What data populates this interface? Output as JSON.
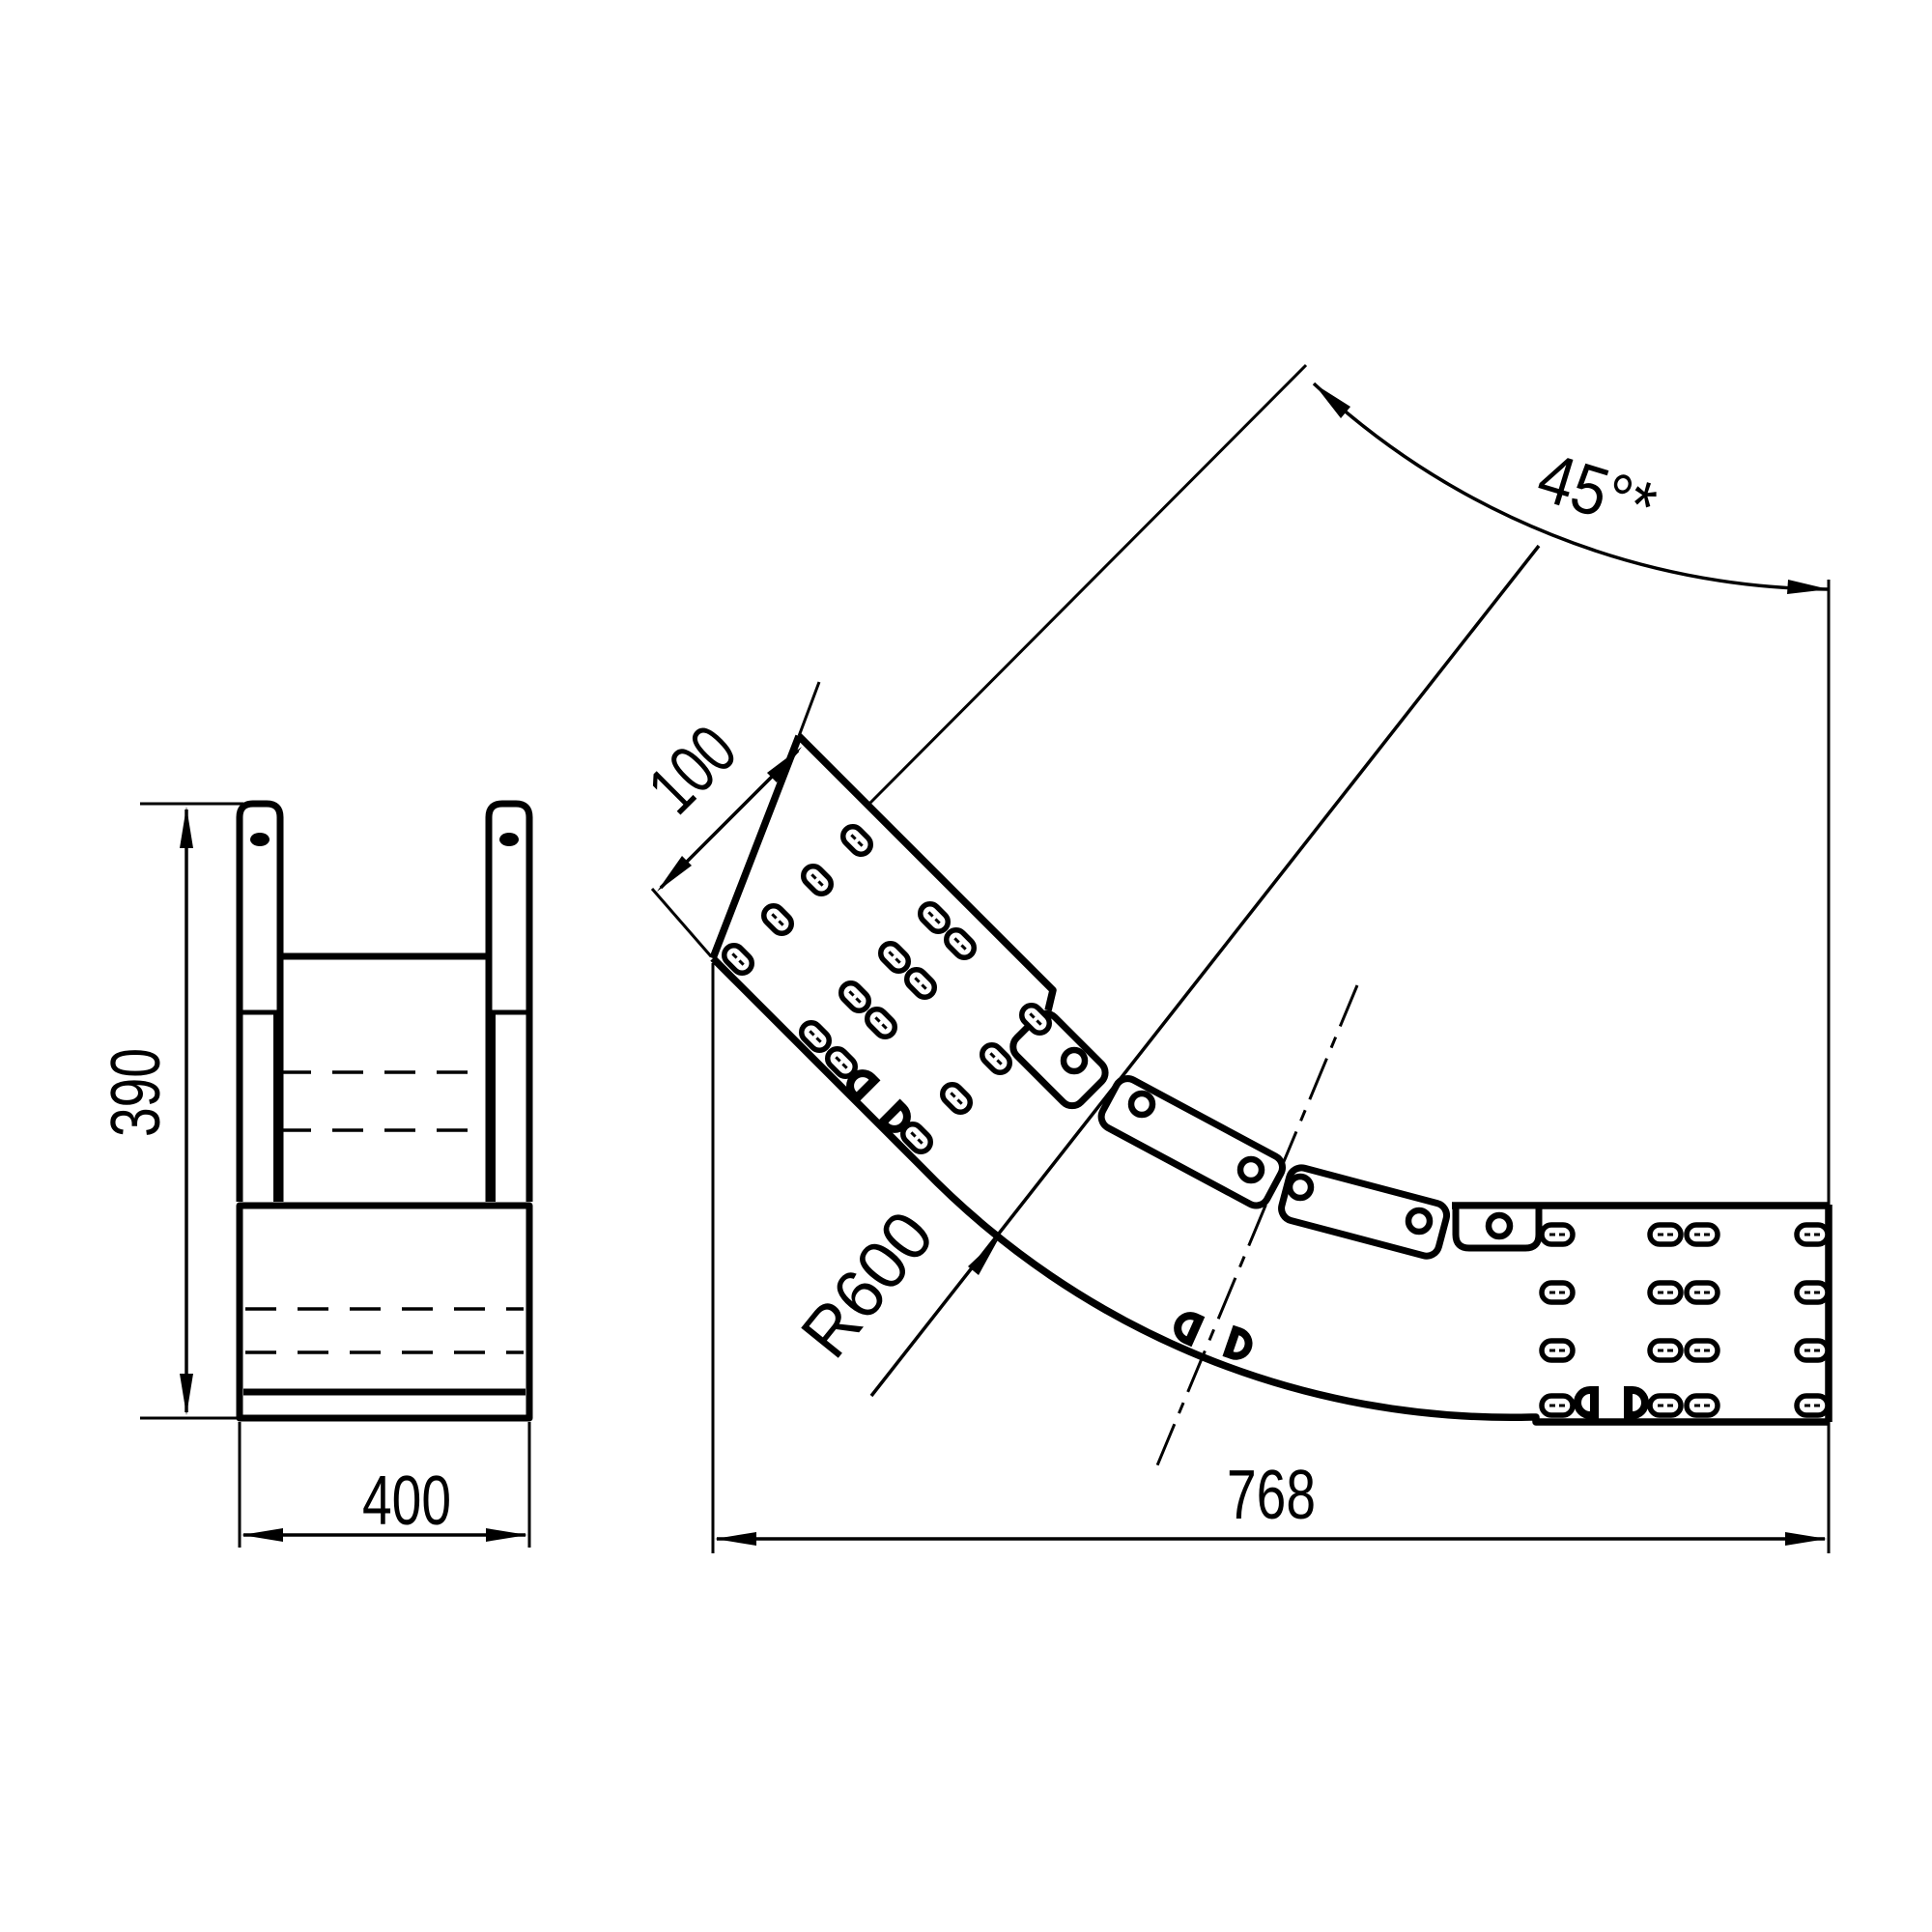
{
  "drawing": {
    "background_color": "#ffffff",
    "line_color": "#000000",
    "side_view": {
      "height_label": "390",
      "width_label": "400"
    },
    "bend_view": {
      "end_length_label": "100",
      "radius_label": "R600",
      "angle_label": "45°*",
      "overall_length_label": "768"
    }
  }
}
